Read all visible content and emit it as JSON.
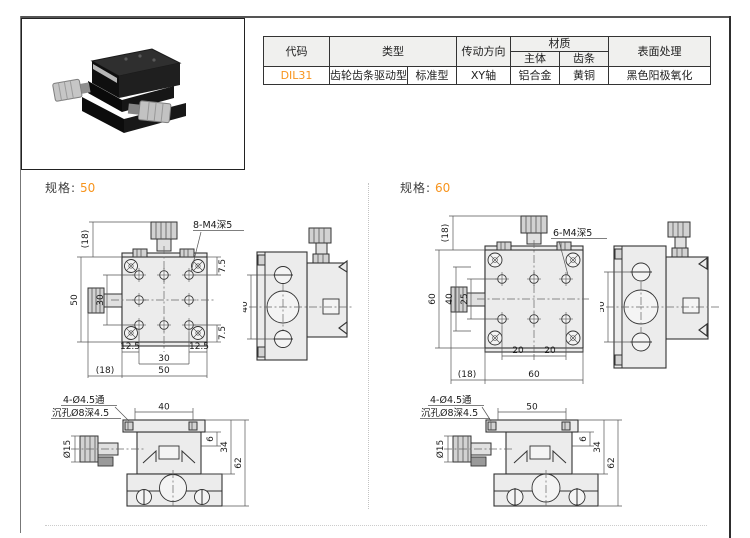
{
  "colors": {
    "accent": "#f7941d",
    "line": "#333333"
  },
  "spec_table": {
    "header": {
      "code": "代码",
      "type": "类型",
      "drive_direction": "传动方向",
      "material": "材质",
      "material_body": "主体",
      "material_rack": "齿条",
      "surface": "表面处理"
    },
    "row": {
      "code": "DIL31",
      "type_main": "齿轮齿条驱动型",
      "type_sub": "标准型",
      "drive_direction": "XY轴",
      "material_body": "铝合金",
      "material_rack": "黄铜",
      "surface": "黑色阳极氧化"
    }
  },
  "sections": {
    "s50": {
      "label": "规格:",
      "value": "50",
      "top": {
        "callout": "8-M4深5",
        "dim_knob_v": "(18)",
        "dim_total_v": "50",
        "dim_inner_v": "30",
        "dim_top": "7.5",
        "dim_bottom": "7.5",
        "dim_left": "12.5",
        "dim_right": "12.5",
        "dim_inner_h": "30",
        "dim_total_h": "50",
        "dim_knob_h": "(18)"
      },
      "side": {
        "dim_height": "40"
      },
      "front": {
        "callout1": "4-Ø4.5通",
        "callout2": "沉孔Ø8深4.5",
        "dim_top": "40",
        "dim_knob": "Ø15",
        "dim_plate": "6",
        "dim_mid": "34",
        "dim_total": "62"
      }
    },
    "s60": {
      "label": "规格:",
      "value": "60",
      "top": {
        "callout": "6-M4深5",
        "dim_knob_v": "(18)",
        "dim_total_v": "60",
        "dim_mid_v": "40",
        "dim_inner_v": "25",
        "dim_left_h": "20",
        "dim_right_h": "20",
        "dim_total_h": "60",
        "dim_knob_h": "(18)"
      },
      "side": {
        "dim_height": "50"
      },
      "front": {
        "callout1": "4-Ø4.5通",
        "callout2": "沉孔Ø8深4.5",
        "dim_top": "50",
        "dim_knob": "Ø15",
        "dim_plate": "6",
        "dim_mid": "34",
        "dim_total": "62"
      }
    }
  }
}
